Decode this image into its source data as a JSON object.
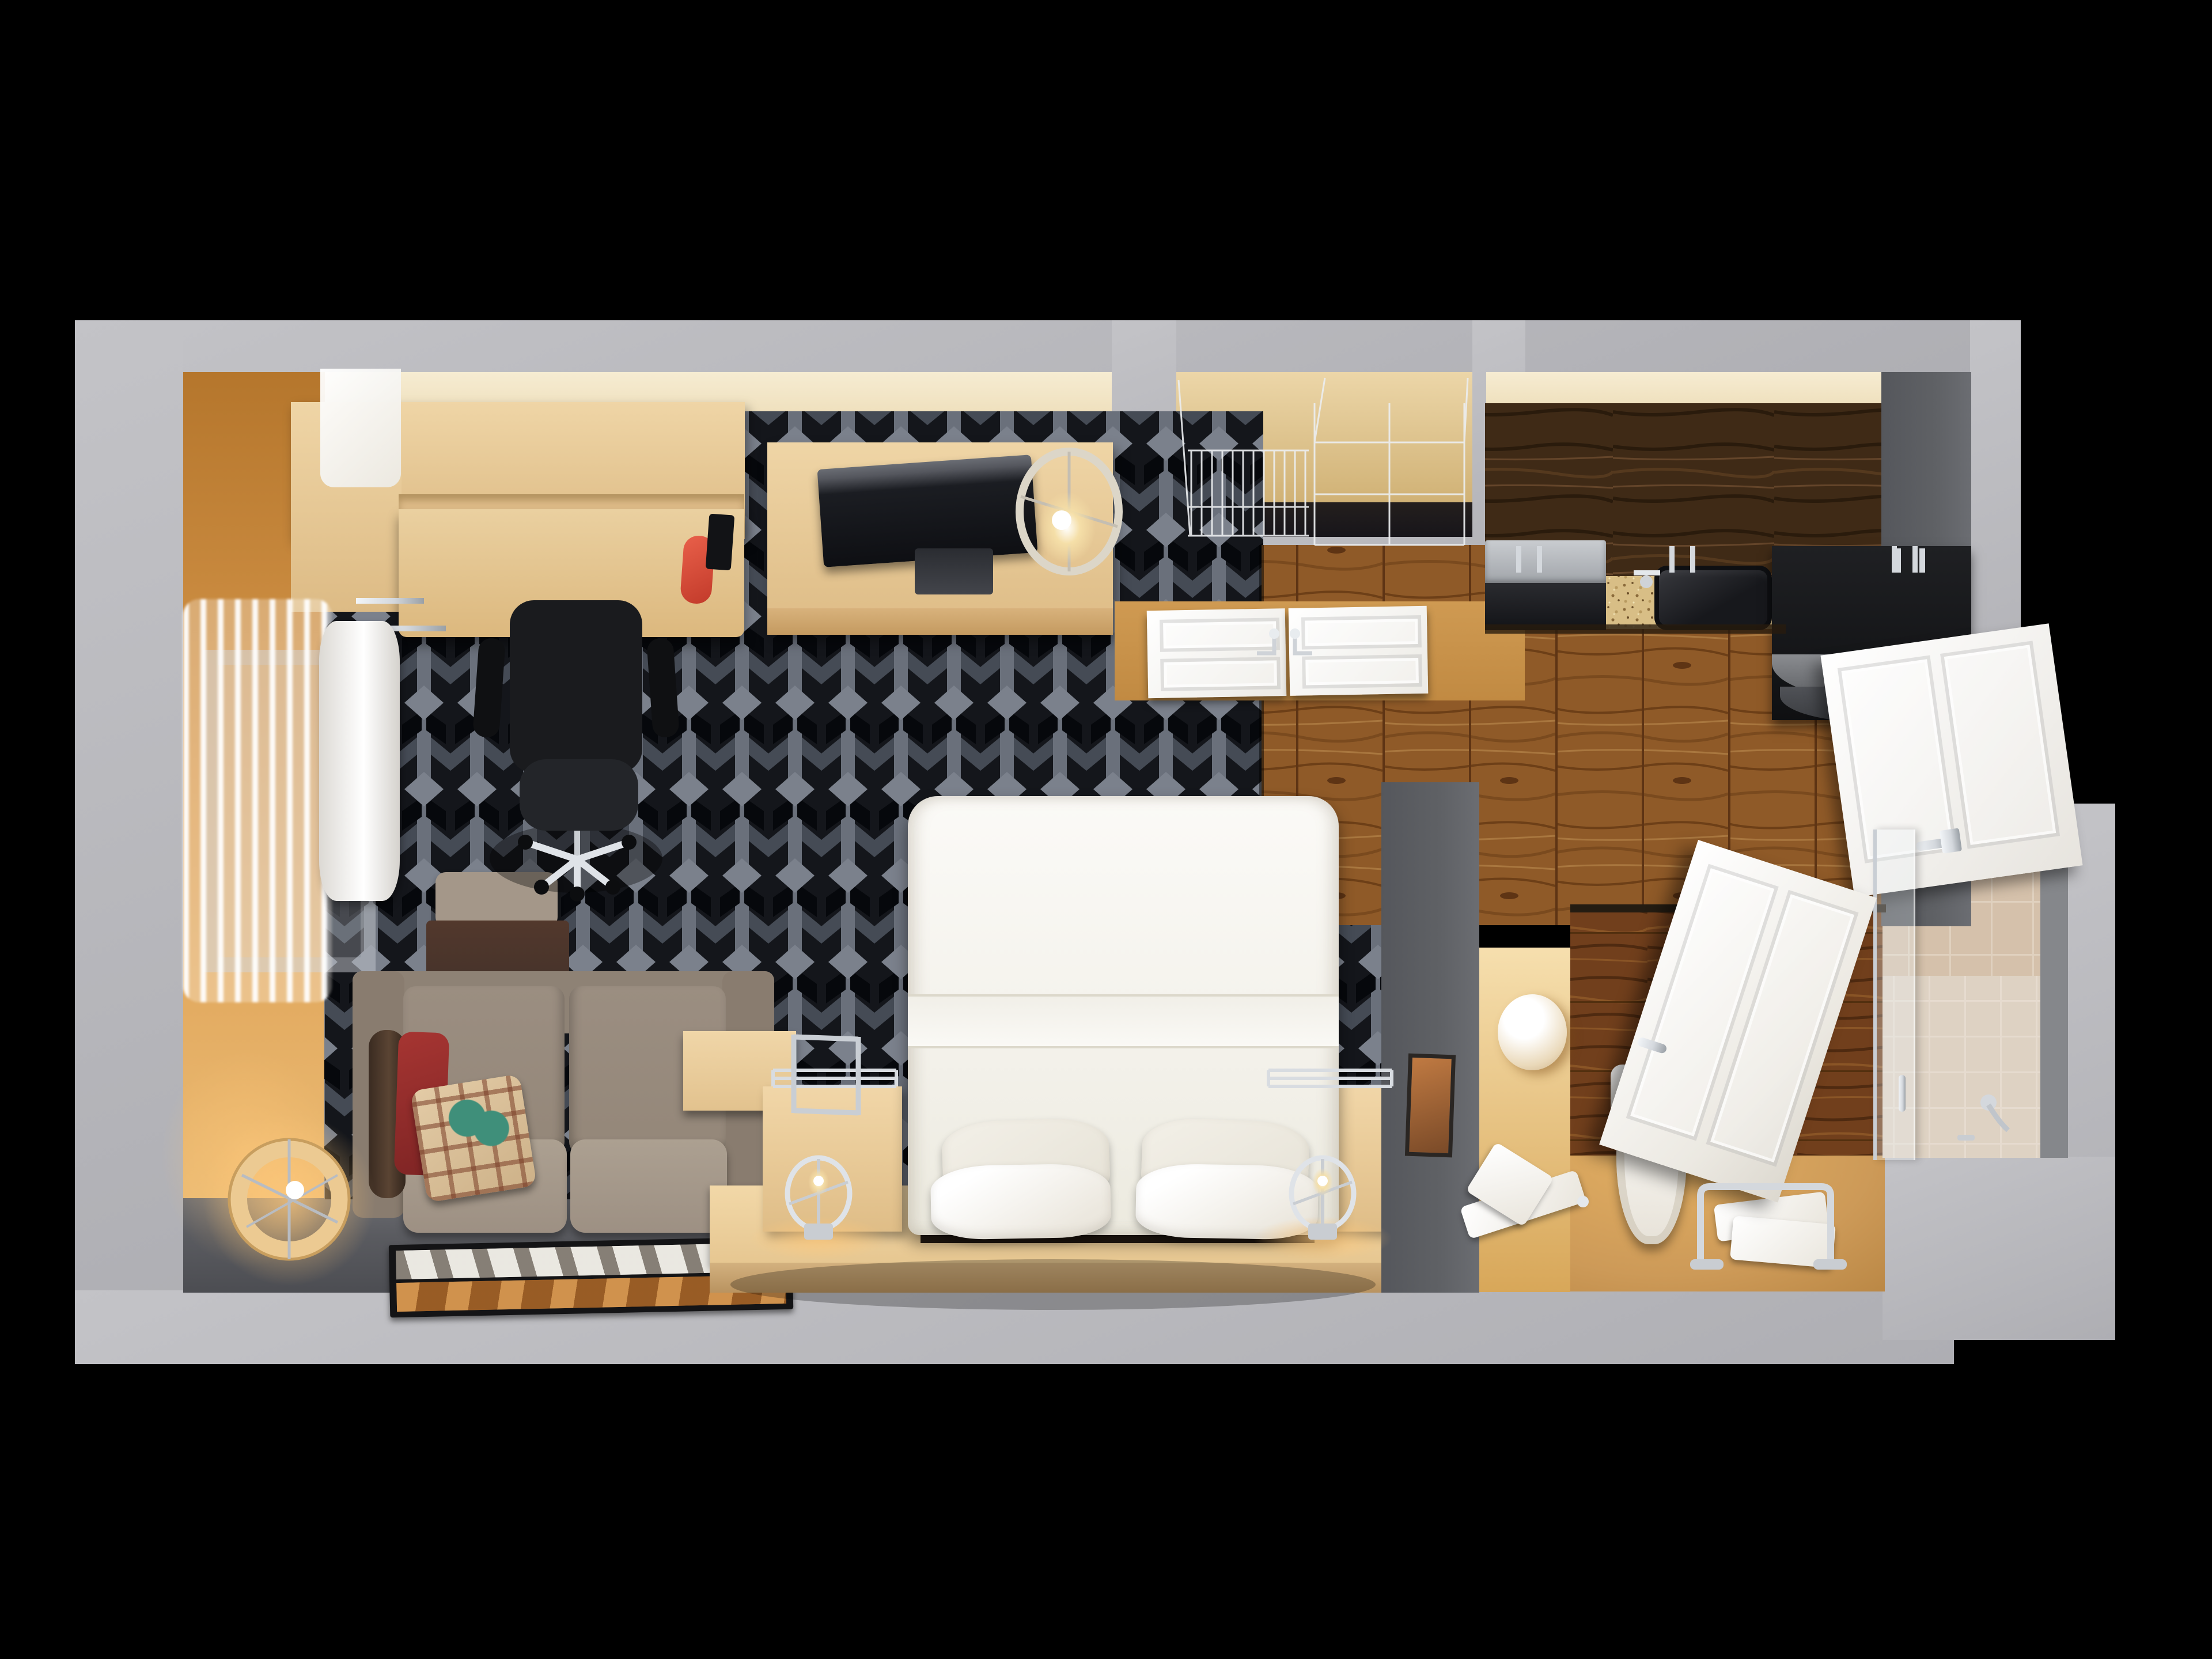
{
  "scene": {
    "type": "3d-floorplan-top-down-render",
    "setting": "extended-stay hotel studio suite",
    "rooms": [
      {
        "name": "bedroom-living-area",
        "floor": "dark geometric hotel carpet with gray lattice pattern",
        "furniture": [
          "wall desk with hutch",
          "black office chair",
          "red desk phone",
          "tv dresser console",
          "flat screen tv",
          "drum table lamp",
          "sheer window curtains",
          "white ac unit",
          "armchair with brown throw",
          "taupe loveseat sofa",
          "red accent cushion",
          "plaid pillow",
          "sofa side table",
          "glowing drum floor lamp",
          "photo area rug",
          "white queen bed",
          "bed pillows",
          "beige bed platform",
          "left nightstand",
          "right nightstand",
          "chrome ring reading lamps",
          "framed wall art"
        ]
      },
      {
        "name": "closet",
        "features": [
          "chrome wire shelving",
          "white double doors with chrome pulls"
        ]
      },
      {
        "name": "kitchen",
        "floor": "oak plank hardwood",
        "features": [
          "dark walnut upper cabinets",
          "speckled granite countertop",
          "stainless cooktop",
          "black undermount sink with faucet",
          "black refrigerator",
          "white entry door"
        ]
      },
      {
        "name": "bathroom",
        "floor": "tan resin floor",
        "features": [
          "walnut accent wall",
          "white toilet",
          "chrome towel stand with white towels",
          "hanging hand towels",
          "sphere sconce light",
          "white door ajar",
          "glass shower screen",
          "beige tiled shower walls",
          "tiled shower floor",
          "chrome shower spout"
        ]
      }
    ],
    "palette": {
      "frame": "#c3c3c7",
      "frame2": "#aeaeb3",
      "orange": "#d99a4e",
      "orange2": "#b5762c",
      "cream": "#efe0bd",
      "beige": "#efd5a6",
      "beige2": "#ddbb85",
      "carpetbase": "#14161b",
      "carpetbar": "#6a707b",
      "carpetdiamond": "#7b818c",
      "floorgray": "#5a5b60",
      "darkwall": "#5f6165",
      "white": "#f4f2ed",
      "chrome": "#d4d8dd",
      "sofa": "#8e8275",
      "sofa2": "#a2958a",
      "red": "#942d2c",
      "brown": "#4c392c",
      "tan": "#cd9a58",
      "wood": "#8a5426",
      "woodcab": "#3f2a16",
      "woodaccent": "#713f1c",
      "granite": "#d8be86",
      "tile": "#e5d4c0",
      "tilefloor": "#efe8dc",
      "black": "#17181b",
      "glow": "#f5d9a0"
    }
  }
}
